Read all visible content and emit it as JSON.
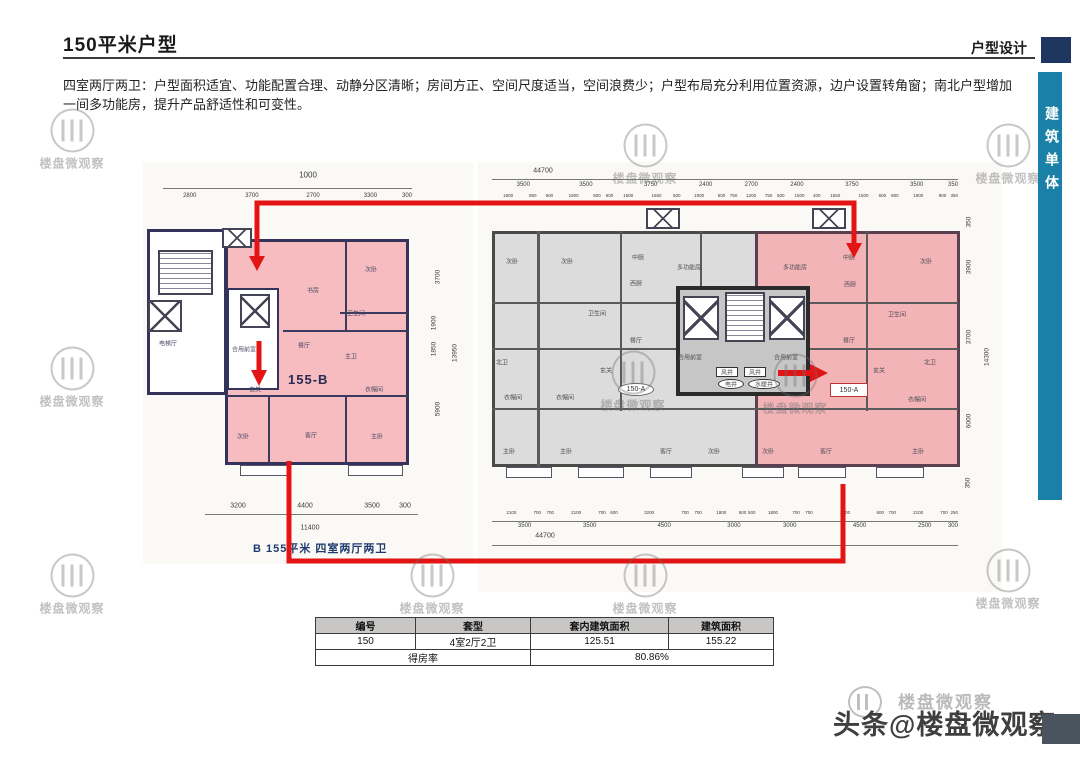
{
  "slide": {
    "title": "150平米户型",
    "corner_tag": "户型设计",
    "side_tab": "建筑单体",
    "description": "四室两厅两卫：户型面积适宜、功能配置合理、动静分区清晰；房间方正、空间尺度适当，空间浪费少；户型布局充分利用位置资源，边户设置转角窗；南北户型增加一间多功能房，提升产品舒适性和可变性。"
  },
  "plan_b": {
    "unit_label": "155-B",
    "caption": "B 155平米 四室两厅两卫",
    "dim_top_total": "1000",
    "dim_top_segments": [
      "2800",
      "3700",
      "2700",
      "3300",
      "300"
    ],
    "dim_right_items": [
      {
        "label": "3700",
        "x": 438,
        "y": 277
      },
      {
        "label": "1900",
        "x": 434,
        "y": 323
      },
      {
        "label": "1850",
        "x": 434,
        "y": 349
      },
      {
        "label": "13950",
        "x": 455,
        "y": 353
      },
      {
        "label": "5900",
        "x": 438,
        "y": 409
      }
    ],
    "dim_bottom_items": [
      {
        "label": "3200",
        "x": 238,
        "y": 506
      },
      {
        "label": "4400",
        "x": 305,
        "y": 506
      },
      {
        "label": "3500",
        "x": 372,
        "y": 506
      },
      {
        "label": "300",
        "x": 405,
        "y": 506
      },
      {
        "label": "11400",
        "x": 310,
        "y": 528
      }
    ],
    "rooms": [
      {
        "label": "玄关",
        "x": 255,
        "y": 389
      },
      {
        "label": "书房",
        "x": 313,
        "y": 290
      },
      {
        "label": "次卧",
        "x": 371,
        "y": 269
      },
      {
        "label": "卫生间",
        "x": 356,
        "y": 313
      },
      {
        "label": "主卫",
        "x": 351,
        "y": 356
      },
      {
        "label": "餐厅",
        "x": 304,
        "y": 345
      },
      {
        "label": "衣帽间",
        "x": 374,
        "y": 389
      },
      {
        "label": "次卧",
        "x": 243,
        "y": 436
      },
      {
        "label": "客厅",
        "x": 311,
        "y": 435
      },
      {
        "label": "主卧",
        "x": 377,
        "y": 436
      },
      {
        "label": "电梯厅",
        "x": 168,
        "y": 343
      },
      {
        "label": "合用前室",
        "x": 244,
        "y": 349
      }
    ]
  },
  "plan_a": {
    "unit_label_left": "150-A",
    "unit_label_right": "150-A",
    "dim_top_total": "44700",
    "dim_top_row1": [
      "3500",
      "3500",
      "3750",
      "2400",
      "2700",
      "2400",
      "3750",
      "3500",
      "350"
    ],
    "dim_top_row2": [
      "1800",
      "950",
      "900",
      "1800",
      "800",
      "600",
      "1500",
      "1650",
      "600",
      "1900",
      "600",
      "750",
      "1200",
      "750",
      "600",
      "1500",
      "400",
      "1650",
      "1500",
      "600",
      "800",
      "1800",
      "900",
      "350"
    ],
    "dim_right_items": [
      {
        "label": "350",
        "x": 969,
        "y": 222
      },
      {
        "label": "3900",
        "x": 969,
        "y": 267
      },
      {
        "label": "3700",
        "x": 969,
        "y": 337
      },
      {
        "label": "14300",
        "x": 987,
        "y": 357
      },
      {
        "label": "6000",
        "x": 969,
        "y": 421
      },
      {
        "label": "350",
        "x": 968,
        "y": 483
      }
    ],
    "dim_bottom_row1": [
      "2100",
      "700",
      "700",
      "2100",
      "700",
      "600",
      "3200",
      "700",
      "700",
      "1800",
      "500",
      "500",
      "1800",
      "700",
      "700",
      "3200",
      "600",
      "700",
      "2100",
      "700",
      "250"
    ],
    "dim_bottom_row2": [
      "3500",
      "3500",
      "4500",
      "3000",
      "3000",
      "4500",
      "2500",
      "300"
    ],
    "dim_bottom_total": "44700",
    "rooms": [
      {
        "label": "次卧",
        "x": 512,
        "y": 261
      },
      {
        "label": "次卧",
        "x": 567,
        "y": 261
      },
      {
        "label": "中厨",
        "x": 638,
        "y": 257
      },
      {
        "label": "多功能房",
        "x": 689,
        "y": 267
      },
      {
        "label": "西厨",
        "x": 636,
        "y": 283
      },
      {
        "label": "卫生间",
        "x": 597,
        "y": 313
      },
      {
        "label": "餐厅",
        "x": 636,
        "y": 340
      },
      {
        "label": "北卫",
        "x": 502,
        "y": 362
      },
      {
        "label": "玄关",
        "x": 606,
        "y": 370
      },
      {
        "label": "衣帽间",
        "x": 513,
        "y": 397
      },
      {
        "label": "衣帽间",
        "x": 565,
        "y": 397
      },
      {
        "label": "主卧",
        "x": 509,
        "y": 451
      },
      {
        "label": "主卧",
        "x": 566,
        "y": 451
      },
      {
        "label": "客厅",
        "x": 666,
        "y": 451
      },
      {
        "label": "次卧",
        "x": 714,
        "y": 451
      },
      {
        "label": "合用前室",
        "x": 690,
        "y": 357
      },
      {
        "label": "合用前室",
        "x": 786,
        "y": 357
      },
      {
        "label": "风井",
        "x": 727,
        "y": 372
      },
      {
        "label": "风井",
        "x": 755,
        "y": 372
      },
      {
        "label": "电井",
        "x": 731,
        "y": 384
      },
      {
        "label": "水暖井",
        "x": 764,
        "y": 384
      },
      {
        "label": "多功能房",
        "x": 795,
        "y": 267
      },
      {
        "label": "中厨",
        "x": 849,
        "y": 257
      },
      {
        "label": "次卧",
        "x": 926,
        "y": 261
      },
      {
        "label": "西厨",
        "x": 850,
        "y": 284
      },
      {
        "label": "卫生间",
        "x": 897,
        "y": 314
      },
      {
        "label": "餐厅",
        "x": 849,
        "y": 340
      },
      {
        "label": "玄关",
        "x": 879,
        "y": 370
      },
      {
        "label": "北卫",
        "x": 930,
        "y": 362
      },
      {
        "label": "衣帽间",
        "x": 917,
        "y": 399
      },
      {
        "label": "次卧",
        "x": 768,
        "y": 451
      },
      {
        "label": "客厅",
        "x": 826,
        "y": 451
      },
      {
        "label": "主卧",
        "x": 918,
        "y": 451
      }
    ]
  },
  "table": {
    "headers": [
      "编号",
      "套型",
      "套内建筑面积",
      "建筑面积"
    ],
    "row": [
      "150",
      "4室2厅2卫",
      "125.51",
      "155.22"
    ],
    "footer_label": "得房率",
    "footer_value": "80.86%"
  },
  "watermark": {
    "text": "楼盘微观察",
    "byline": "头条@楼盘微观察",
    "positions": [
      {
        "x": 72,
        "y": 140
      },
      {
        "x": 645,
        "y": 155
      },
      {
        "x": 1008,
        "y": 155
      },
      {
        "x": 72,
        "y": 378
      },
      {
        "x": 633,
        "y": 382
      },
      {
        "x": 795,
        "y": 385
      },
      {
        "x": 72,
        "y": 585
      },
      {
        "x": 432,
        "y": 585
      },
      {
        "x": 645,
        "y": 585
      },
      {
        "x": 1008,
        "y": 580
      }
    ]
  },
  "colors": {
    "accent_red": "#e21414",
    "teal_tab": "#1b80a8",
    "navy_square": "#1e3560",
    "pink_highlight": "#f5b9bd",
    "gray_unit": "#dcdcdc"
  }
}
